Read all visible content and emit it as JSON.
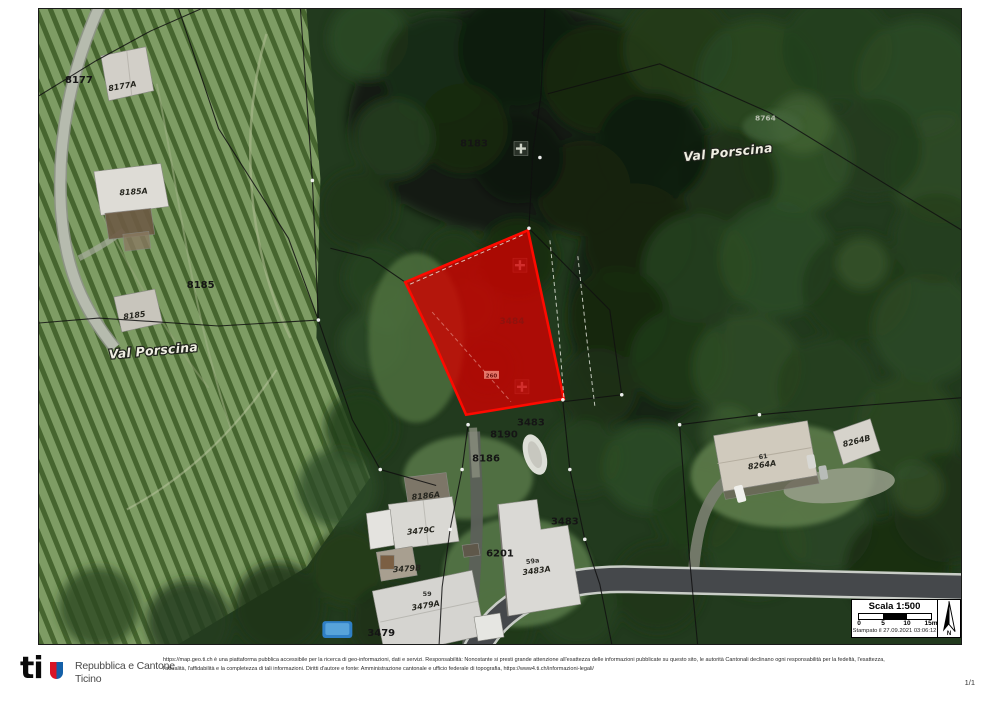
{
  "page": {
    "page_number": "1/1"
  },
  "map": {
    "highlight_color": "#d40000",
    "labels": [
      {
        "text": "8177"
      },
      {
        "text": "8177A"
      },
      {
        "text": "8185A"
      },
      {
        "text": "8185"
      },
      {
        "text": "8185"
      },
      {
        "text": "Val Porscina"
      },
      {
        "text": "8183"
      },
      {
        "text": "8764"
      },
      {
        "text": "Val Porscina"
      },
      {
        "text": "3484"
      },
      {
        "text": "260"
      },
      {
        "text": "3483"
      },
      {
        "text": "8190"
      },
      {
        "text": "8186"
      },
      {
        "text": "8186A"
      },
      {
        "text": "3479C"
      },
      {
        "text": "3479B"
      },
      {
        "text": "59"
      },
      {
        "text": "3479A"
      },
      {
        "text": "6201"
      },
      {
        "text": "3483"
      },
      {
        "text": "59a"
      },
      {
        "text": "3483A"
      },
      {
        "text": "61"
      },
      {
        "text": "8264A"
      },
      {
        "text": "8264B"
      },
      {
        "text": "3479"
      }
    ],
    "scale": {
      "title": "Scala 1:500",
      "ticks": [
        "0",
        "5",
        "10",
        "15m"
      ],
      "stamp": "Stampato il 27.09.2021 03:06:12",
      "north": "N"
    }
  },
  "footer": {
    "logo_text": "ti",
    "org_line1": "Repubblica e Cantone",
    "org_line2": "Ticino",
    "disclaimer_line1": "https://map.geo.ti.ch è una piattaforma pubblica accessibile per la ricerca di geo-informazioni, dati e servizi. Responsabilità: Nonostante si presti grande attenzione all'esattezza delle informazioni pubblicate su questo sito, le autorità Cantonali declinano ogni responsabilità per la fedeltà, l'esattezza,",
    "disclaimer_line2": "l'attualità, l'affidabilità e la completezza di tali informazioni. Diritti d'autore e fonte: Amministrazione cantonale e ufficio federale di topografia, https://www4.ti.ch/informazioni-legali/"
  }
}
